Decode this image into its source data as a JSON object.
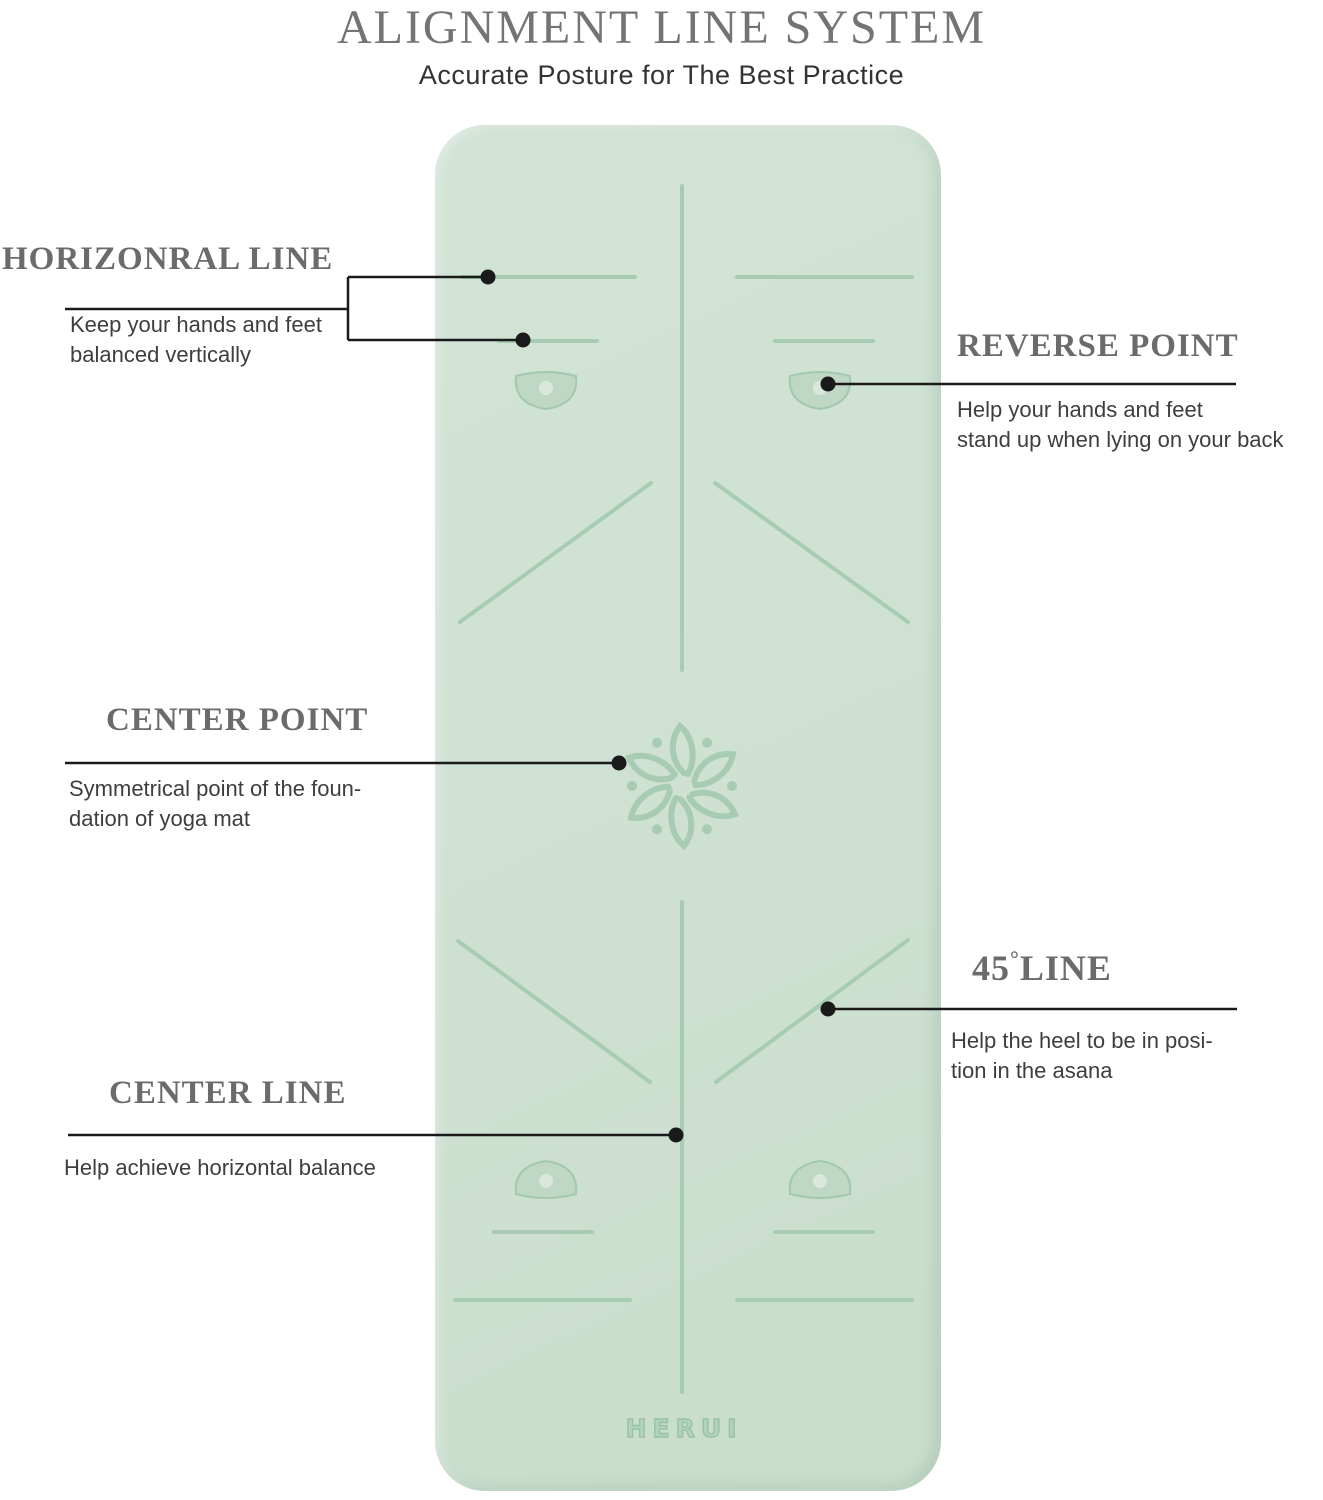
{
  "header": {
    "title": "ALIGNMENT LINE SYSTEM",
    "subtitle": "Accurate Posture for The Best Practice"
  },
  "callouts": {
    "horizontal_line": {
      "title": "HORIZONRAL LINE",
      "desc1": "Keep your hands and feet",
      "desc2": "balanced vertically"
    },
    "reverse_point": {
      "title": "REVERSE POINT",
      "desc1": "Help your hands and feet",
      "desc2": "stand up when lying on your back"
    },
    "center_point": {
      "title": "CENTER POINT",
      "desc1": "Symmetrical point of the foun-",
      "desc2": "dation of yoga mat"
    },
    "line_45": {
      "number": "45",
      "degree": "°",
      "word": "LINE",
      "desc1": "Help the heel to be in posi-",
      "desc2": "tion in the asana"
    },
    "center_line": {
      "title": "CENTER LINE",
      "desc1": "Help achieve horizontal balance"
    }
  },
  "mat": {
    "brand": "HERUI",
    "color": "#cfe1d3",
    "line_color": "#a7ccb3"
  },
  "colors": {
    "heading_text": "#6b6b6b",
    "body_text": "#3e3e3e",
    "leader_line": "#1a1a1a"
  }
}
